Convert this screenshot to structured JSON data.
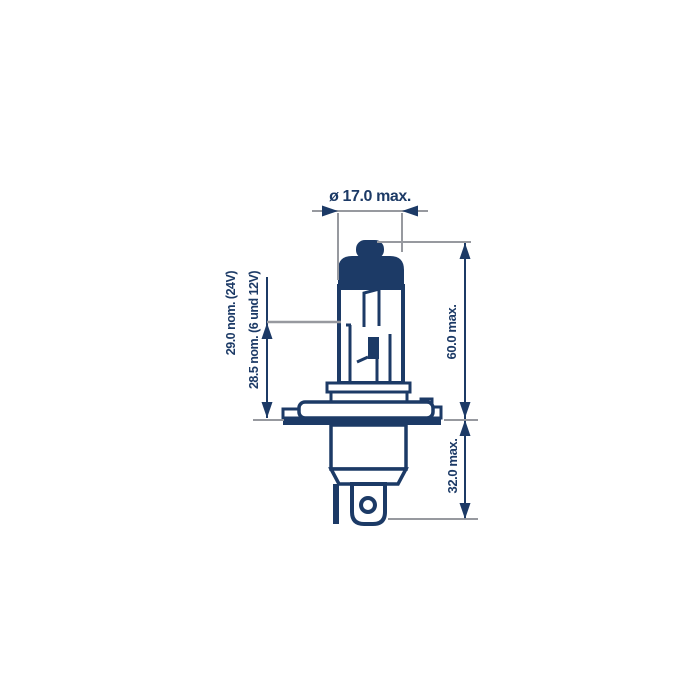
{
  "diagram": {
    "subject": "halogen-headlamp-bulb-dimension-drawing",
    "dimensions": {
      "diameter_label": "ø 17.0 max.",
      "overall_length_label": "60.0 max.",
      "base_length_label": "32.0 max.",
      "light_center_24v_label": "29.0 nom. (24V)",
      "light_center_6_12v_label": "28.5 nom. (6 und 12V)"
    },
    "colors": {
      "line_navy": "#1c3a66",
      "extension_gray": "#97999f",
      "background": "#ffffff"
    }
  }
}
